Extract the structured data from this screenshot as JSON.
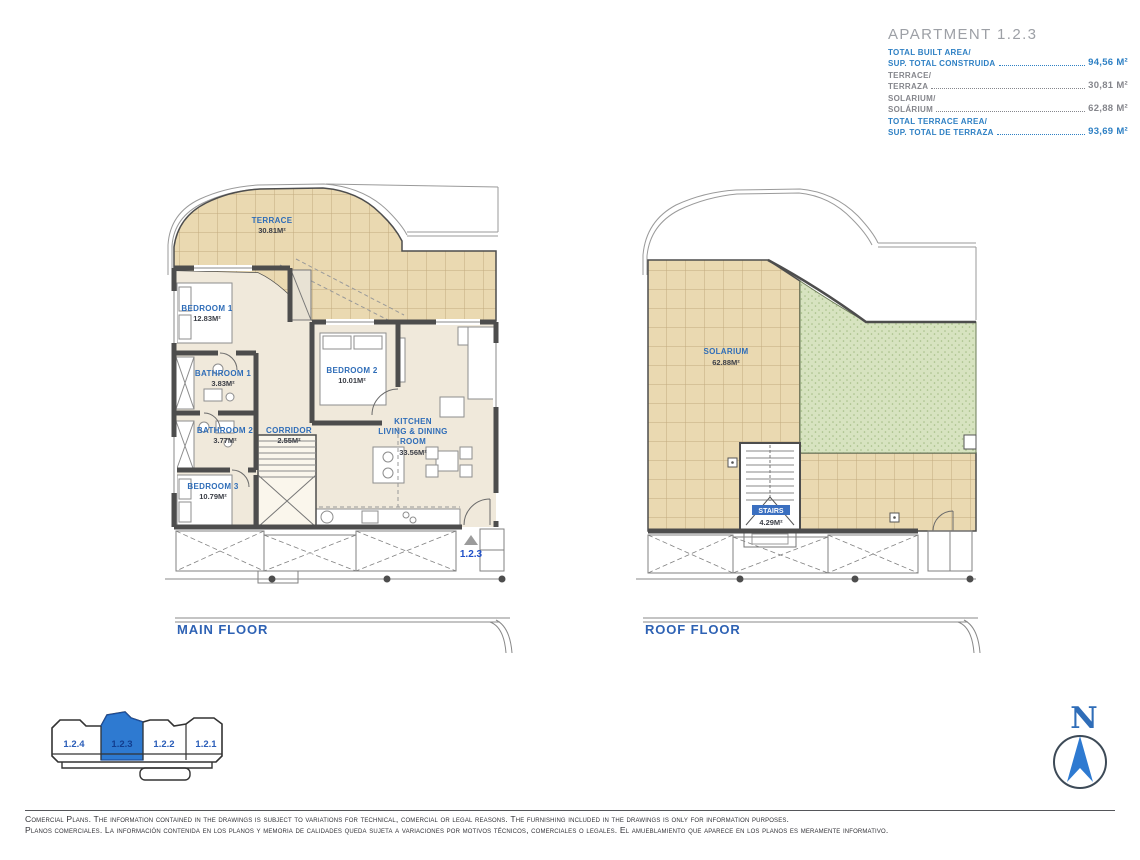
{
  "header": {
    "title": "APARTMENT 1.2.3",
    "metrics": [
      {
        "label_en": "TOTAL BUILT AREA/",
        "label_es": "SUP. TOTAL CONSTRUIDA",
        "value": "94,56 M²",
        "style": "primary"
      },
      {
        "label_en": "TERRACE/",
        "label_es": "TERRAZA",
        "value": "30,81 M²",
        "style": "secondary"
      },
      {
        "label_en": "SOLARIUM/",
        "label_es": "SOLÁRIUM",
        "value": "62,88 M²",
        "style": "secondary"
      },
      {
        "label_en": "TOTAL TERRACE AREA/",
        "label_es": "SUP. TOTAL DE TERRAZA",
        "value": "93,69 M²",
        "style": "primary"
      }
    ]
  },
  "main_floor": {
    "title": "MAIN FLOOR",
    "unit_marker": "1.2.3",
    "rooms": {
      "terrace": {
        "name": "TERRACE",
        "area": "30.81M²"
      },
      "bedroom1": {
        "name": "BEDROOM 1",
        "area": "12.83M²"
      },
      "bathroom1": {
        "name": "BATHROOM 1",
        "area": "3.83M²"
      },
      "bedroom2": {
        "name": "BEDROOM 2",
        "area": "10.01M²"
      },
      "bathroom2": {
        "name": "BATHROOM 2",
        "area": "3.77M²"
      },
      "corridor": {
        "name": "CORRIDOR",
        "area": "2.55M²"
      },
      "kitchen": {
        "line1": "KITCHEN",
        "line2": "LIVING & DINING",
        "line3": "ROOM",
        "area": "33.56M²"
      },
      "bedroom3": {
        "name": "BEDROOM 3",
        "area": "10.79M²"
      }
    }
  },
  "roof_floor": {
    "title": "ROOF FLOOR",
    "rooms": {
      "solarium": {
        "name": "SOLARIUM",
        "area": "62.88M²"
      },
      "stairs": {
        "name": "STAIRS",
        "area": "4.29M²"
      }
    }
  },
  "key_plan": {
    "units": [
      {
        "id": "1.2.4",
        "active": false
      },
      {
        "id": "1.2.3",
        "active": true
      },
      {
        "id": "1.2.2",
        "active": false
      },
      {
        "id": "1.2.1",
        "active": false
      }
    ]
  },
  "compass": {
    "north_label": "N"
  },
  "footer": {
    "line_en": "Comercial Plans. The information contained in the drawings is subject to variations for technical, comercial or legal reasons. The furnishing included in the drawings is only for information purposes.",
    "line_es": "Planos comerciales. La información contenida en los planos y memoria de calidades queda sujeta a variaciones por motivos técnicos, comerciales o legales. El amueblamiento que aparece en los planos es meramente informativo."
  },
  "colors": {
    "accent_blue": "#2e80c4",
    "plan_label_blue": "#2f6db8",
    "tile_tan": "#ead9b1",
    "lawn_green": "#d7e3c0",
    "active_unit_blue": "#2e7ad1",
    "wall_gray": "#4d4d4d"
  }
}
